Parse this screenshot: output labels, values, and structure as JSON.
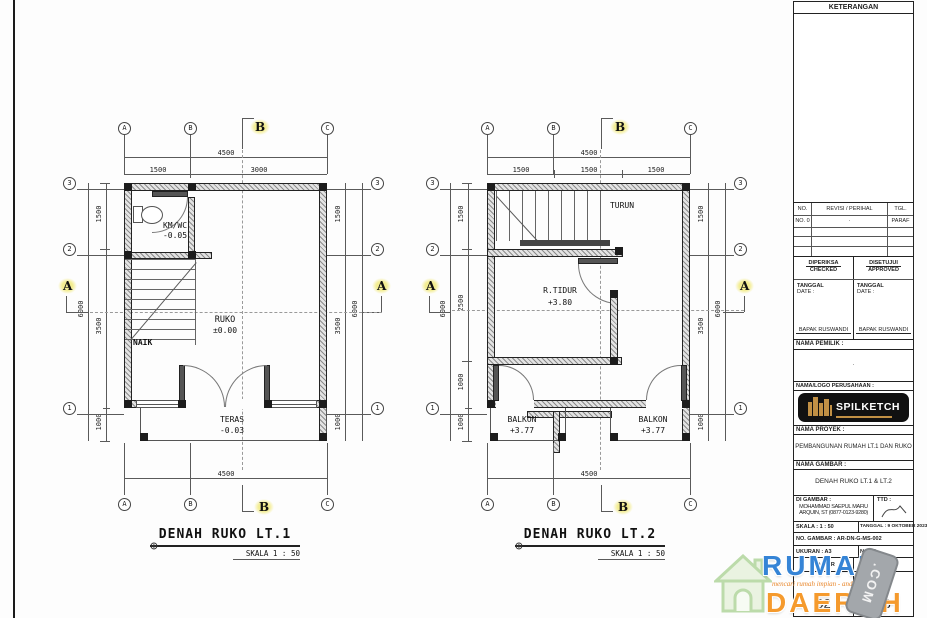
{
  "drawing": {
    "plan1": {
      "title": "DENAH RUKO LT.1",
      "scale": "SKALA 1 : 50",
      "stair": "NAIK",
      "cols": [
        "A",
        "B",
        "C"
      ],
      "rows": [
        "3",
        "2",
        "1"
      ],
      "section_a": "A",
      "section_b": "B",
      "rooms": {
        "kmwc": "KM/WC",
        "kmwc_level": "-0.05",
        "ruko": "RUKO",
        "ruko_level": "±0.00",
        "teras": "TERAS",
        "teras_level": "-0.03"
      },
      "dims": {
        "t": "4500",
        "ts": [
          "1500",
          "3000"
        ],
        "b": "4500",
        "lo": "6000",
        "ls": [
          "1500",
          "3500",
          "1000"
        ],
        "ro": "6000",
        "rs": [
          "1500",
          "3500",
          "1000"
        ]
      }
    },
    "plan2": {
      "title": "DENAH RUKO LT.2",
      "scale": "SKALA 1 : 50",
      "stair": "TURUN",
      "cols": [
        "A",
        "B",
        "C"
      ],
      "rows": [
        "3",
        "2",
        "1"
      ],
      "section_a": "A",
      "section_b": "B",
      "rooms": {
        "tidur": "R.TIDUR",
        "tidur_level": "+3.80",
        "balkon1": "BALKON",
        "balkon1_level": "+3.77",
        "balkon2": "BALKON",
        "balkon2_level": "+3.77"
      },
      "dims": {
        "t": "4500",
        "ts": [
          "1500",
          "1500",
          "1500"
        ],
        "b": "4500",
        "lo": "6000",
        "ls": [
          "1500",
          "2500",
          "1000",
          "1000"
        ],
        "ro": "6000",
        "rs": [
          "1500",
          "3500",
          "1000"
        ]
      }
    },
    "symbols": {
      "datum": "⊕"
    }
  },
  "titleblock": {
    "keterangan": "KETERANGAN",
    "rev": {
      "h1": "NO.",
      "h2": "REVISI / PERIHAL",
      "h3": "TGL.",
      "r1c1": "NO. 0",
      "r1c2": "·",
      "r1c3": "PARAF"
    },
    "checked": {
      "label": "DIPERIKSA",
      "sublabel": "CHECKED",
      "date_label": "TANGGAL",
      "date_sublabel": "DATE :",
      "name": "BAPAK RUSWANDI"
    },
    "approved": {
      "label": "DISETUJUI",
      "sublabel": "APPROVED",
      "date_label": "TANGGAL",
      "date_sublabel": "DATE :",
      "name": "BAPAK RUSWANDI"
    },
    "owner_label": "NAMA PEMILIK :",
    "owner_value": "·",
    "company_label": "NAMA/LOGO PERUSAHAAN :",
    "logo_text": "SPILKETCH",
    "project_label": "NAMA PROYEK :",
    "project_value": "PEMBANGUNAN RUMAH LT.1 DAN RUKO",
    "drawing_label": "NAMA GAMBAR :",
    "drawing_value": "DENAH RUKO LT.1 & LT.2",
    "drawn_label": "DI GAMBAR :",
    "drawn_name": "MOHAMMAD SAEPUL MAFIU ARQUIN, ST",
    "drawn_phone": "(0877-0123-9280)",
    "ttd_label": "TTD :",
    "scale_row": "SKALA : 1 : 50",
    "date_row": "TANGGAL : 9 OKTOBER 2023",
    "no_gambar_row": "NO. GAMBAR : AR-DN-G-MS-002",
    "ukuran_row": "UKURAN : A3",
    "no_row": "NO : 2",
    "sheet_no_label": "NO. LBR",
    "sheet_total_label": "JML. LBR",
    "sheet_no": "02",
    "sheet_total": "03"
  },
  "watermark": {
    "line1": "RUMAH",
    "line2": "DAERAH",
    "tagline": "mencari rumah impian - anda",
    "stamp": ".COM",
    "blue": "#3584d6",
    "orange": "#f59a2d"
  }
}
